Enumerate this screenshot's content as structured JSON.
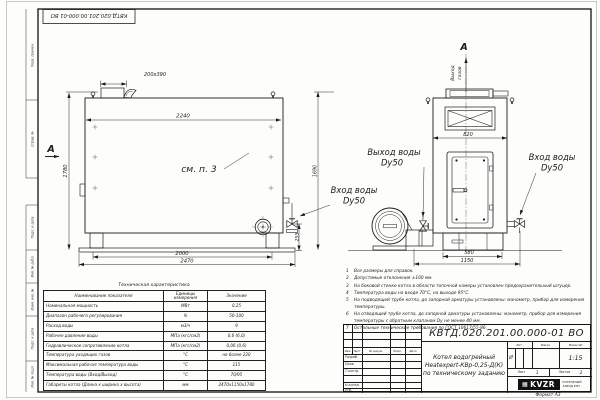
{
  "frame": {
    "doc_number_top": "КВТД.020.201.00.000-01 ВО",
    "format_note": "Формат А3",
    "stamps": [
      "Перв. примен.",
      "Справ. №",
      "Подп. и дата",
      "Инв. № дубл.",
      "Взам. инв. №",
      "Подп. и дата",
      "Инв. № подл."
    ]
  },
  "side_view": {
    "section_label": "А",
    "see_note": "см. п. 3",
    "dims": {
      "duct": "200х390",
      "width_top": "2240",
      "height": "1780",
      "base": "2000",
      "length": "2470",
      "pipe_height": "255"
    }
  },
  "front_view": {
    "section_label": "А",
    "gas_outlet_word1": "Выход",
    "gas_outlet_word2": "газов",
    "dims": {
      "width": "820",
      "height": "1690",
      "base": "580",
      "overall": "1150"
    }
  },
  "water_labels": {
    "outlet_title": "Выход воды",
    "outlet_dn": "Dy50",
    "inlet_left_title": "Вход воды",
    "inlet_left_dn": "Dy50",
    "inlet_right_title": "Вход воды",
    "inlet_right_dn": "Dy50"
  },
  "notes": {
    "items": [
      "Все размеры для справок.",
      "Допустимые отклонения ±100 мм.",
      "На боковой стенке котла в области топочной камеры установлен предохранительный штуцер.",
      "Температура воды на входе 70°С, на выходе 95°С.",
      "На подводящей трубе котла, до запорной арматуры установлены: манометр, прибор для измерения температуры.",
      "На отводящей трубе котла, до запорной арматуры установлены: манометр, прибор для измерения температуры с обратным клапаном Dy не менее 40 мм.",
      "Остальные технические требования по ГОСТ 10617/55-86."
    ]
  },
  "spec_table": {
    "title": "Техническая характеристика",
    "headers": [
      "Наименование показателя",
      "Единицы измерения",
      "Значение"
    ],
    "rows": [
      [
        "Номинальная мощность",
        "МВт",
        "0,25"
      ],
      [
        "Диапазон рабочего регулирования",
        "%",
        "50-100"
      ],
      [
        "Расход воды",
        "м3/ч",
        "9"
      ],
      [
        "Рабочее давление воды",
        "МПа (кгс/см2)",
        "0,6 (6,0)"
      ],
      [
        "Гидравлическое сопротивление котла",
        "МПа (кгс/см2)",
        "0,06 (0,6)"
      ],
      [
        "Температура уходящих газов",
        "°С",
        "не более 220"
      ],
      [
        "Максимальная рабочая температура воды",
        "°С",
        "115"
      ],
      [
        "Температура воды (Вход/Выход)",
        "°С",
        "70/95"
      ],
      [
        "Габариты котла (Длина х ширина х высота)",
        "мм",
        "2470х1150х1780"
      ]
    ]
  },
  "title_block": {
    "doc_number": "КВТД.020.201.00.000-01 ВО",
    "product_line1": "Котел водогрейный",
    "product_line2": "Heatexpert-КВр-0,25-Д(К)",
    "product_line3": "по техническому заданию",
    "rev_headers": [
      "Изм.",
      "Лист",
      "№ докум.",
      "Подп.",
      "Дата"
    ],
    "roles": [
      "Разраб.",
      "Пров.",
      "Т.контр.",
      "Н.контр.",
      "Утв."
    ],
    "lit_header": "Лит.",
    "mass_header": "Масса",
    "scale_header": "Масштаб",
    "lit_value": "И",
    "scale_value": "1:15",
    "sheet_label": "Лист",
    "sheet_value": "1",
    "sheets_label": "Листов",
    "sheets_value": "2",
    "logo_text": "KVZR",
    "logo_caption1": "КОТЕЛЬНЫЙ",
    "logo_caption2": "ЗАВОД РЭП"
  }
}
